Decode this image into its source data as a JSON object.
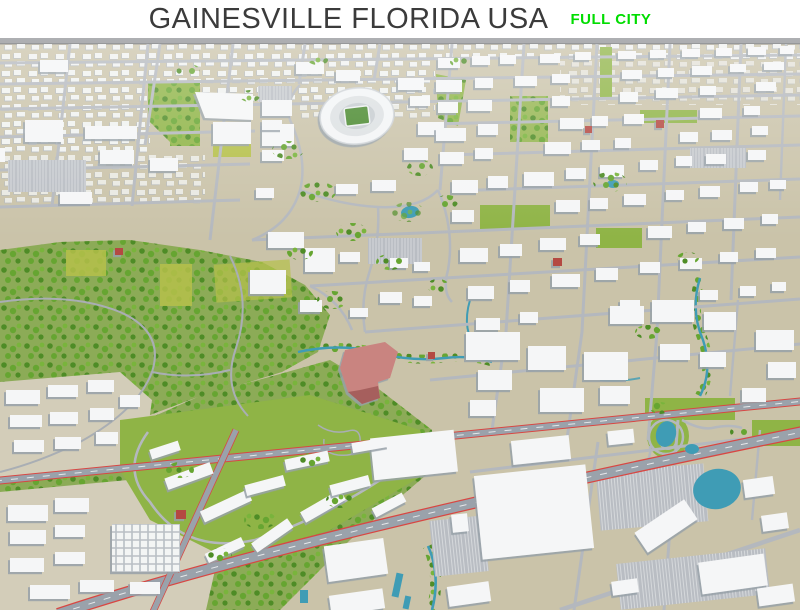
{
  "header": {
    "title": "GAINESVILLE FLORIDA USA",
    "badge": "FULL CITY"
  },
  "scene": {
    "label": "3D low-poly aerial render of the full city of Gainesville, Florida",
    "landmarks": [
      "stadium",
      "university-campus",
      "downtown-grid",
      "conservation-forest",
      "hospital-landmark-building",
      "lakes-and-ponds",
      "highways",
      "shopping-mall"
    ]
  },
  "colors": {
    "title_text": "#3b3b3b",
    "badge_green": "#00dd00",
    "edge_gray": "#8e9094",
    "ground": "#cac3a9",
    "ground_light": "#d3cdb9",
    "campus_ground": "#cfc7ad",
    "road": "#b4b8be",
    "highway": "#9aa2ab",
    "highway_red": "#d84743",
    "building": "#f5f6f7",
    "building_shadow": "#97a0a8",
    "forest_base": "#8cab57",
    "tree_dark": "#4e8c26",
    "tree_mid": "#66a531",
    "tree_light": "#79b43c",
    "grass": "#8fb446",
    "field_yellow": "#b5c04a",
    "water": "#3f9cb5",
    "landmark": "#c98480",
    "landmark_dark": "#a65f5d",
    "red_accent": "#b44a42",
    "parking": "#b9bdc3"
  }
}
